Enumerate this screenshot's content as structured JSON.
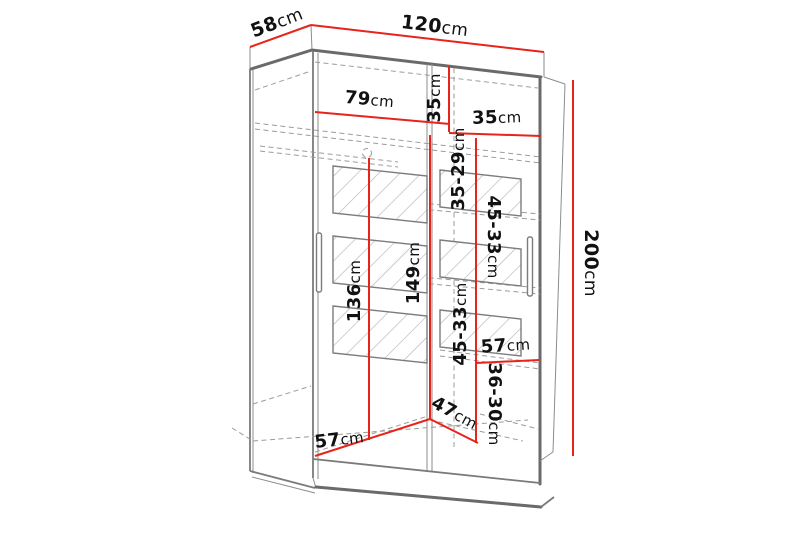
{
  "diagram": {
    "kind": "wardrobe-dimension-drawing",
    "unit": "cm"
  },
  "colors": {
    "dimension_line": "#e8231a",
    "structure_line": "#6a6a6a",
    "hidden_line": "#9b9b9b",
    "label_text": "#111111",
    "background": "#ffffff"
  },
  "dimensions": {
    "depth": {
      "value": "58",
      "unit": "cm"
    },
    "width": {
      "value": "120",
      "unit": "cm"
    },
    "height": {
      "value": "200",
      "unit": "cm"
    },
    "left_section_width": {
      "value": "79",
      "unit": "cm"
    },
    "top_shelf_drop": {
      "value": "35",
      "unit": "cm"
    },
    "top_right_shelf_width": {
      "value": "35",
      "unit": "cm"
    },
    "right_gap_1": {
      "value": "35-29",
      "unit": "cm"
    },
    "right_gap_2": {
      "value": "45-33",
      "unit": "cm"
    },
    "right_gap_3": {
      "value": "45-33",
      "unit": "cm"
    },
    "right_gap_4": {
      "value": "36-30",
      "unit": "cm"
    },
    "left_hanging_height": {
      "value": "136",
      "unit": "cm"
    },
    "center_interior_height": {
      "value": "149",
      "unit": "cm"
    },
    "right_shelf_width": {
      "value": "57",
      "unit": "cm"
    },
    "bottom_compartment_depth": {
      "value": "47",
      "unit": "cm"
    },
    "bottom_left_width": {
      "value": "57",
      "unit": "cm"
    }
  }
}
